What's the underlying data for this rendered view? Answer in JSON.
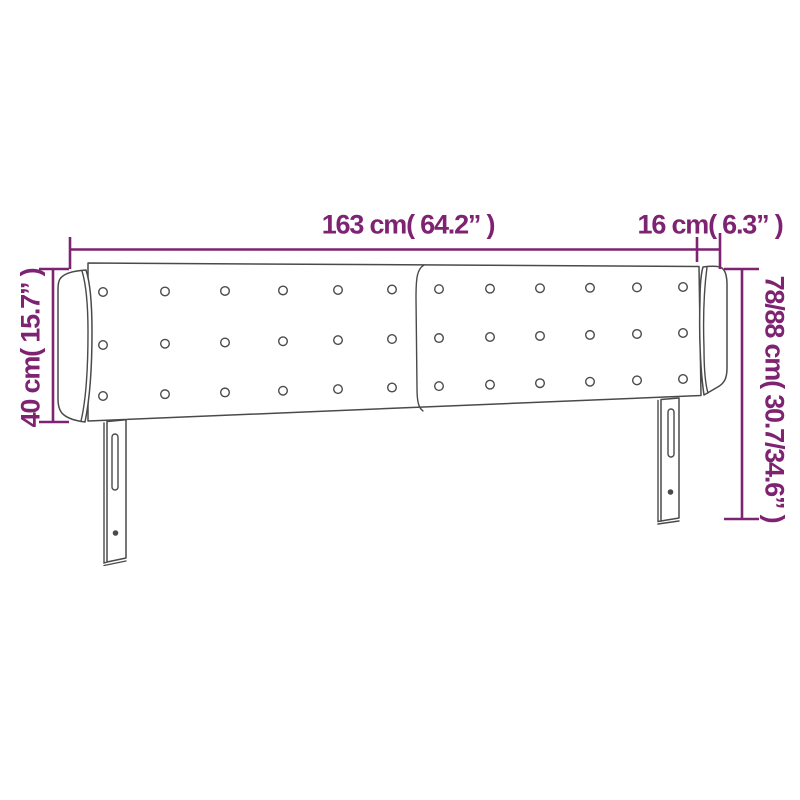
{
  "colors": {
    "dimension": "#7e2372",
    "outline": "#4a4a4a"
  },
  "diagram": {
    "type": "product-dimension-diagram",
    "product": "headboard-with-ears",
    "labels": {
      "width_main": "163 cm( 64.2” )",
      "width_wing": "16 cm( 6.3” )",
      "height_left": "40 cm( 15.7” )",
      "height_right": "78/88 cm( 30.7/34.6” )"
    },
    "dimensions": {
      "width_main_cm": 163,
      "width_main_inch": 64.2,
      "width_wing_cm": 16,
      "width_wing_inch": 6.3,
      "height_left_cm": 40,
      "height_left_inch": 15.7,
      "height_right_cm": "78/88",
      "height_right_inch": "30.7/34.6"
    },
    "buttons": {
      "rows": 3,
      "columns": 12
    }
  }
}
